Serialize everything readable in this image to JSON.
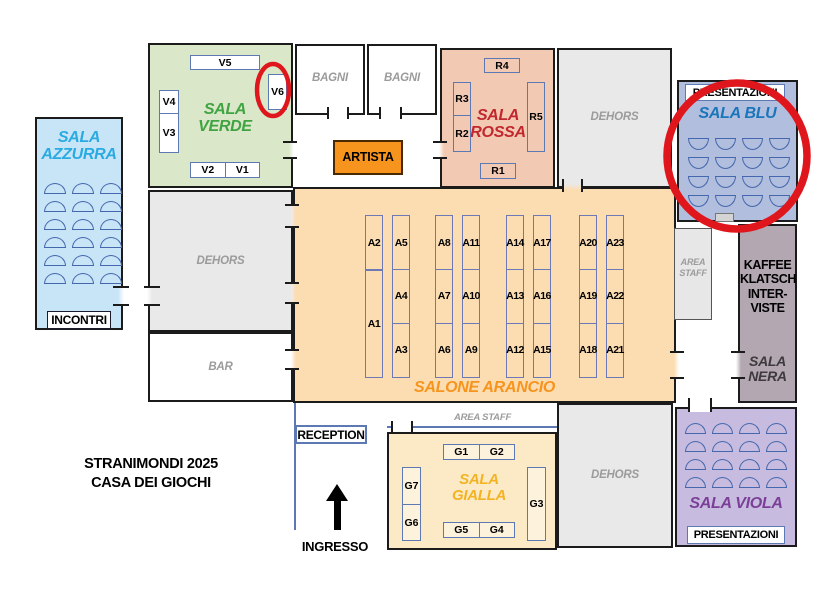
{
  "colors": {
    "annotation": "#e0161d",
    "azzurra_fill": "#c8e4f7",
    "azzurra_title": "#29abe2",
    "verde_fill": "#dbe7c9",
    "verde_title": "#3fa441",
    "rossa_fill": "#f2cab4",
    "rossa_title": "#c1272d",
    "blu_fill": "#b1bedd",
    "blu_title": "#1b75bb",
    "arancio_fill": "#fcdcb1",
    "arancio_title": "#f7941d",
    "gialla_fill": "#fce9c5",
    "gialla_title": "#f2b424",
    "viola_fill": "#c7bcdf",
    "viola_title": "#7c3f98",
    "nera_fill": "#b3a8b1",
    "nera_title": "#3d393c",
    "dehors_fill": "#e9e9e9",
    "muted_text": "#9b9b9b",
    "artista_fill": "#f7941e",
    "table_border": "#5c79b4"
  },
  "event": {
    "line1": "STRANIMONDI 2025",
    "line2": "CASA DEI GIOCHI"
  },
  "rooms": {
    "azzurra": {
      "title_line1": "SALA",
      "title_line2": "AZZURRA",
      "badge": "INCONTRI",
      "seat_rows": 6,
      "seat_cols": 3
    },
    "verde": {
      "title_line1": "SALA",
      "title_line2": "VERDE",
      "tables": {
        "v1": "V1",
        "v2": "V2",
        "v3": "V3",
        "v4": "V4",
        "v5": "V5",
        "v6": "V6"
      }
    },
    "bagni_left": {
      "label": "BAGNI"
    },
    "bagni_right": {
      "label": "BAGNI"
    },
    "artista": {
      "label": "ARTISTA"
    },
    "rossa": {
      "title_line1": "SALA",
      "title_line2": "ROSSA",
      "tables": {
        "r1": "R1",
        "r2": "R2",
        "r3": "R3",
        "r4": "R4",
        "r5": "R5"
      }
    },
    "dehors_top": {
      "label": "DEHORS"
    },
    "blu": {
      "badge": "PRESENTAZIONI",
      "title": "SALA BLU",
      "seat_rows": 4,
      "seat_cols": 4
    },
    "arancio": {
      "title": "SALONE ARANCIO",
      "columns": [
        [
          "A2",
          "A1"
        ],
        [
          "A5",
          "A4",
          "A3"
        ],
        [
          "A8",
          "A7",
          "A6"
        ],
        [
          "A11",
          "A10",
          "A9"
        ],
        [
          "A14",
          "A13",
          "A12"
        ],
        [
          "A17",
          "A16",
          "A15"
        ],
        [
          "A20",
          "A19",
          "A18"
        ],
        [
          "A23",
          "A22",
          "A21"
        ]
      ]
    },
    "dehors_left": {
      "label": "DEHORS"
    },
    "bar": {
      "label": "BAR"
    },
    "area_staff_right": {
      "line1": "AREA",
      "line2": "STAFF"
    },
    "kaffee": {
      "line1": "KAFFEE",
      "line2": "KLATSCH",
      "line3": "INTER-",
      "line4": "VISTE"
    },
    "nera": {
      "title_line1": "SALA",
      "title_line2": "NERA"
    },
    "reception": {
      "label": "RECEPTION"
    },
    "area_staff_bottom": {
      "label": "AREA STAFF"
    },
    "gialla": {
      "title_line1": "SALA",
      "title_line2": "GIALLA",
      "tables": {
        "g1": "G1",
        "g2": "G2",
        "g3": "G3",
        "g4": "G4",
        "g5": "G5",
        "g6": "G6",
        "g7": "G7"
      }
    },
    "dehors_bottom": {
      "label": "DEHORS"
    },
    "viola": {
      "title": "SALA VIOLA",
      "badge": "PRESENTAZIONI",
      "seat_rows": 4,
      "seat_cols": 4
    },
    "ingresso": {
      "label": "INGRESSO"
    }
  }
}
